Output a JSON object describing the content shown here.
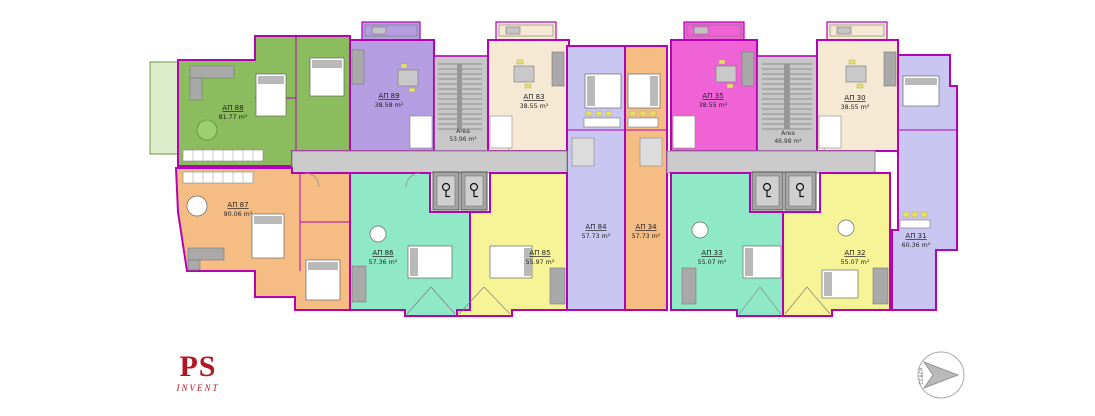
{
  "plan": {
    "apartments": [
      {
        "id": "АП 88",
        "area": "81.77 m²",
        "color": "#8bbd5e"
      },
      {
        "id": "АП 89",
        "area": "38.58 m²",
        "color": "#b49de0"
      },
      {
        "id": "АП 83",
        "area": "38.55 m²",
        "color": "#f6e9d3"
      },
      {
        "id": "АП 35",
        "area": "38.55 m²",
        "color": "#ef63d6"
      },
      {
        "id": "АП 30",
        "area": "38.55 m²",
        "color": "#f6e9d3"
      },
      {
        "id": "АП 31",
        "area": "60.36 m²",
        "color": "#c9c6f1"
      },
      {
        "id": "АП 87",
        "area": "90.06 m²",
        "color": "#f5bd84"
      },
      {
        "id": "АП 86",
        "area": "57.36 m²",
        "color": "#90e9c6"
      },
      {
        "id": "АП 85",
        "area": "55.97 m²",
        "color": "#f7f397"
      },
      {
        "id": "АП 84",
        "area": "57.73 m²",
        "color": "#c9c6f1"
      },
      {
        "id": "АП 34",
        "area": "57.73 m²",
        "color": "#f5bd84"
      },
      {
        "id": "АП 33",
        "area": "55.07 m²",
        "color": "#90e9c6"
      },
      {
        "id": "АП 32",
        "area": "55.07 m²",
        "color": "#f7f397"
      }
    ],
    "stair_cores": [
      {
        "label": "Area",
        "area": "53.96 m²"
      },
      {
        "label": "Area",
        "area": "46.98 m²"
      }
    ],
    "colors": {
      "wall": "#b303b3",
      "corridor": "#cbcbcb",
      "stair_core": "#c7c7c7",
      "terrace": "#dcebc9",
      "elevator": "#a5a5a5"
    }
  },
  "logo": {
    "title": "PS",
    "subtitle": "INVENT",
    "color": "#b01825"
  },
  "compass": {
    "label": "СЕВЕР"
  }
}
